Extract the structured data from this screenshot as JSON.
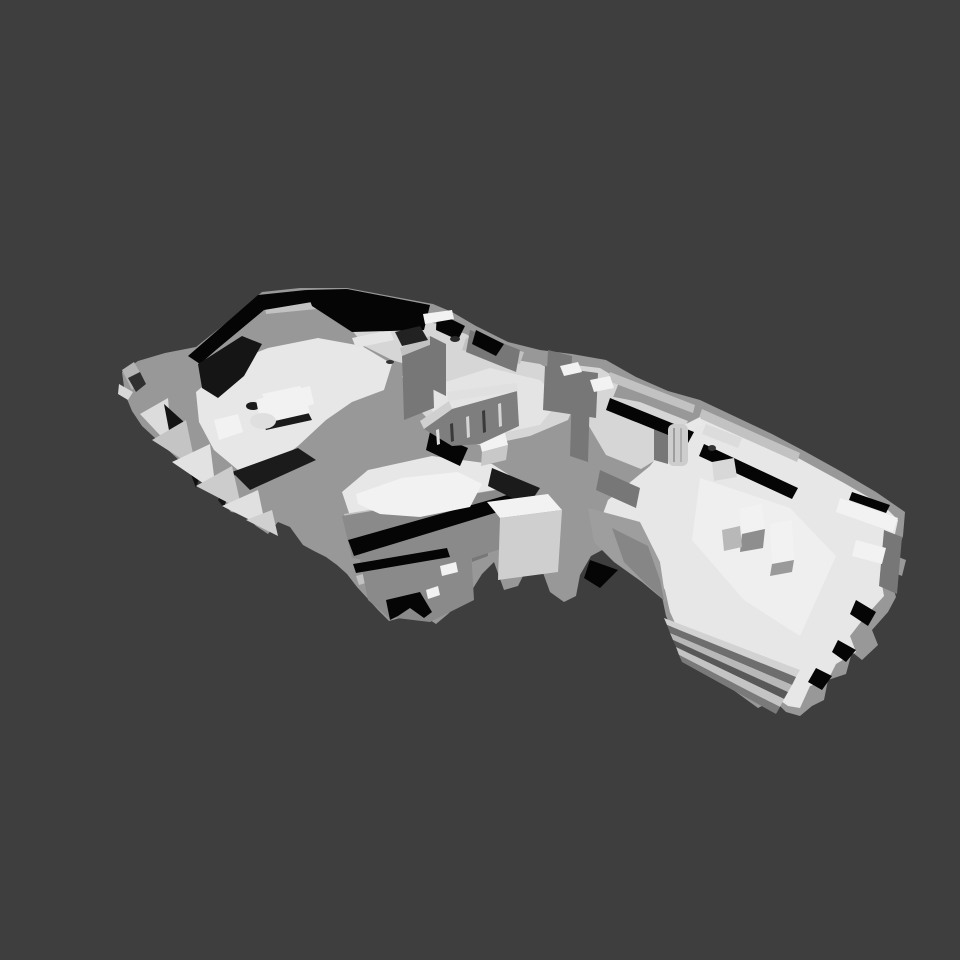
{
  "viewport": {
    "width": 960,
    "height": 960,
    "background": "#3E3E3E",
    "content_description": "Untextured grayscale 3D reconstruction mesh of a multi-room apartment interior, viewed from an elevated oblique angle; no text or UI chrome visible"
  },
  "palette": {
    "background": "#3E3E3E",
    "shadow": "#050505",
    "shadow_soft": "#1B1B1B",
    "floor_bright": "#F2F2F2",
    "floor_light": "#E7E7E7",
    "floor_mid": "#D6D6D6",
    "wall_light": "#C2C2C2",
    "wall_mid": "#989898",
    "wall_dark": "#777777",
    "wall_deep": "#5A5A5A"
  },
  "scene": {
    "regions": [
      {
        "id": "living-room",
        "label": "living room with sofa, armchair and round table (upper left)"
      },
      {
        "id": "kitchen-strip",
        "label": "kitchen / hallway strip with counters and desk (top middle)"
      },
      {
        "id": "stair-railing",
        "label": "stairwell balustrade with bench (center)"
      },
      {
        "id": "bedroom-block",
        "label": "bedroom block with bed (lower left)"
      },
      {
        "id": "corridor",
        "label": "corridor with mesh drape artifact connecting the wings"
      },
      {
        "id": "right-wing-room",
        "label": "large open room with boxes, heater and window sill (right)"
      },
      {
        "id": "staircase",
        "label": "staircase steps (lower right)"
      },
      {
        "id": "scan-fringe",
        "label": "jagged triangular scan-artifact fringe (left edge)"
      },
      {
        "id": "roof-voids",
        "label": "black unscanned void bands along the top edge"
      }
    ]
  }
}
